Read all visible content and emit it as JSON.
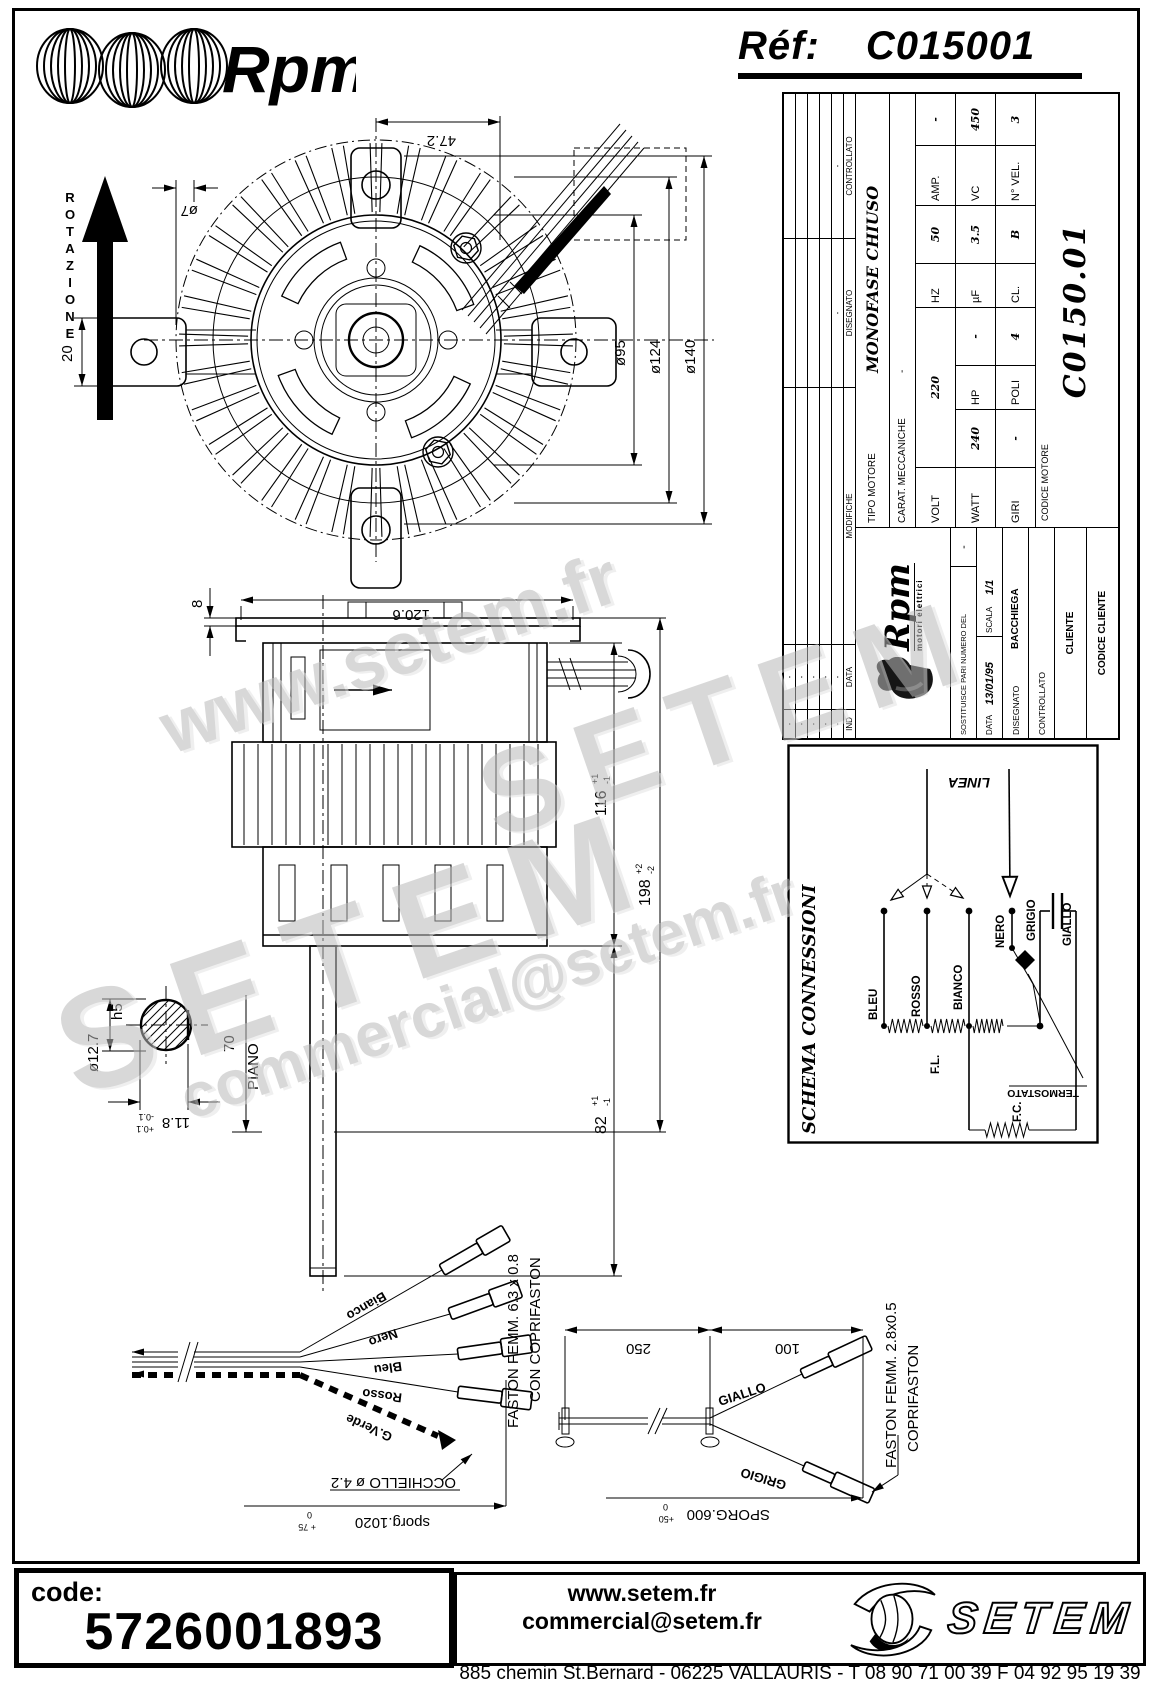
{
  "header": {
    "brand_script": "Rpm",
    "ref_label": "Réf:",
    "ref_value": "C015001"
  },
  "watermarks": {
    "w1": "www.setem.fr",
    "w2": "SETEM",
    "w3": "commercial@setem.fr",
    "w4": "SETEM"
  },
  "title_block": {
    "revision": {
      "col_ind": "IND",
      "col_data": "DATA",
      "col_modifiche": "MODIFICHE",
      "col_disegnato": "DISEGNATO",
      "col_controllato": "CONTROLLATO",
      "dash": "-"
    },
    "logo": {
      "script": "Rpm",
      "subtitle": "motori elettrici"
    },
    "rows": {
      "sostituisce_label": "SOSTITUISCE PARI NUMERO DEL",
      "sostituisce_value": "-",
      "data_label": "DATA",
      "data_value": "13/01/95",
      "scala_label": "SCALA",
      "scala_value": "1/1",
      "disegnato_label": "DISEGNATO",
      "disegnato_value": "BACCHIEGA",
      "controllato_label": "CONTROLLATO",
      "controllato_value": "",
      "cliente_label": "CLIENTE",
      "codice_cliente_label": "CODICE CLIENTE",
      "codice_motore_label": "CODICE MOTORE",
      "codice_motore_value": "C0150.01"
    },
    "spec": {
      "tipo_label": "TIPO MOTORE",
      "tipo_value": "MONOFASE CHIUSO",
      "carat_label": "CARAT. MECCANICHE",
      "carat_value": "-",
      "volt_label": "VOLT",
      "volt_value": "220",
      "hz_label": "HZ",
      "hz_value": "50",
      "amp_label": "AMP.",
      "amp_value": "-",
      "watt_label": "WATT",
      "watt_value": "240",
      "hp_label": "HP",
      "hp_value": "-",
      "uf_label": "µF",
      "uf_value": "3.5",
      "vc_label": "VC",
      "vc_value": "450",
      "giri_label": "GIRI",
      "giri_value": "-",
      "poli_label": "POLI",
      "poli_value": "4",
      "cl_label": "CL.",
      "cl_value": "B",
      "nvel_label": "N° VEL.",
      "nvel_value": "3"
    }
  },
  "schema": {
    "title": "SCHEMA CONNESSIONI",
    "linea": "LINEA",
    "bleu": "BLEU",
    "rosso": "ROSSO",
    "bianco": "BIANCO",
    "nero": "NERO",
    "grigio": "GRIGIO",
    "giallo": "GIALLO",
    "fl": "F.L.",
    "fc": "F.C.",
    "termostato": "TERMOSTATO"
  },
  "front_view": {
    "rotazione": "ROTAZIONE",
    "dim_47_2": "47.2",
    "dim_o7": "ø7",
    "dim_20": "20",
    "dim_o95": "ø95",
    "dim_o124": "ø124",
    "dim_o140": "ø140"
  },
  "side_view": {
    "dim_120_6": "120.6",
    "dim_8": "8",
    "dim_38a": "38",
    "dim_40": "40",
    "dim_38b": "38",
    "dim_116": "116",
    "dim_116_tp": "+1",
    "dim_116_tm": "-1",
    "dim_198": "198",
    "dim_198_tp": "+2",
    "dim_198_tm": "-2",
    "dim_82": "82",
    "dim_82_tp": "+1",
    "dim_82_tm": "-1",
    "dim_70": "70",
    "piano": "PIANO"
  },
  "shaft_detail": {
    "dim_o12_7": "ø12.7",
    "h5": "h5",
    "dim_11_8": "11.8",
    "tp": "+0.1",
    "tm": "-0.1"
  },
  "harness": {
    "bianco": "Bianco",
    "nero": "Nero",
    "bleu": "Bleu",
    "rosso": "Rosso",
    "gverde": "G.Verde",
    "faston": "FASTON FEMM. 6.3 x 0.8",
    "coprifaston": "CON COPRIFASTON",
    "occhiello": "OCCHIELLO ø 4.2",
    "sporg": "sporg.1020",
    "sporg_tp": "+ 75",
    "sporg_tm": "0"
  },
  "cap_cable": {
    "dim_250": "250",
    "dim_100": "100",
    "giallo": "GIALLO",
    "grigio": "GRIGIO",
    "sporg": "SPORG.600",
    "sporg_tp": "+50",
    "sporg_tm": "0",
    "faston": "FASTON FEMM. 2.8x0.5",
    "coprifaston": "COPRIFASTON"
  },
  "footer": {
    "code_label": "code:",
    "code_value": "5726001893",
    "website": "www.setem.fr",
    "email": "commercial@setem.fr",
    "address": "885 chemin St.Bernard - 06225 VALLAURIS - T 08 90 71 00 39 F 04 92 95 19 39",
    "brand": "SETEM"
  }
}
